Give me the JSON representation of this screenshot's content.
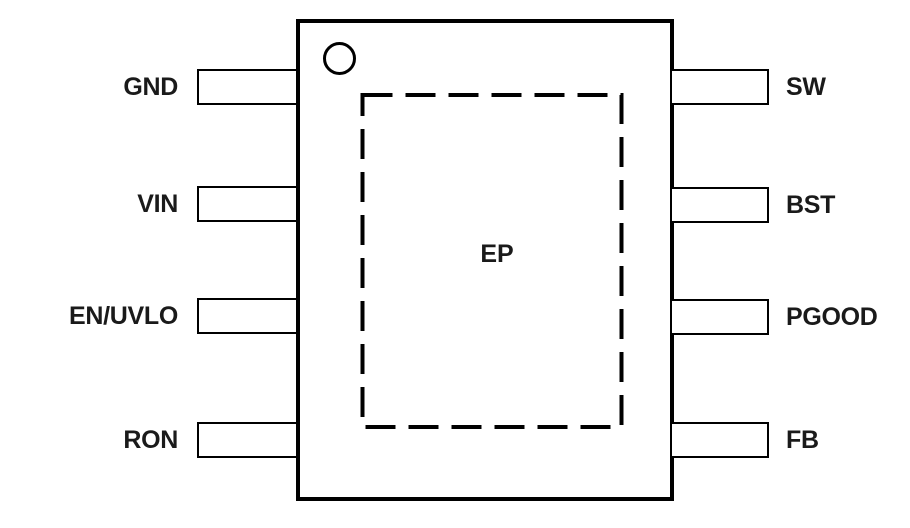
{
  "diagram": {
    "type": "ic-package-pinout",
    "ep_label": "EP",
    "left_pins": [
      "GND",
      "VIN",
      "EN/UVLO",
      "RON"
    ],
    "right_pins": [
      "SW",
      "BST",
      "PGOOD",
      "FB"
    ],
    "pin1_marker": "circle-icon",
    "colors": {
      "line": "#000000",
      "background": "#ffffff",
      "text": "#1a1a1a"
    }
  }
}
